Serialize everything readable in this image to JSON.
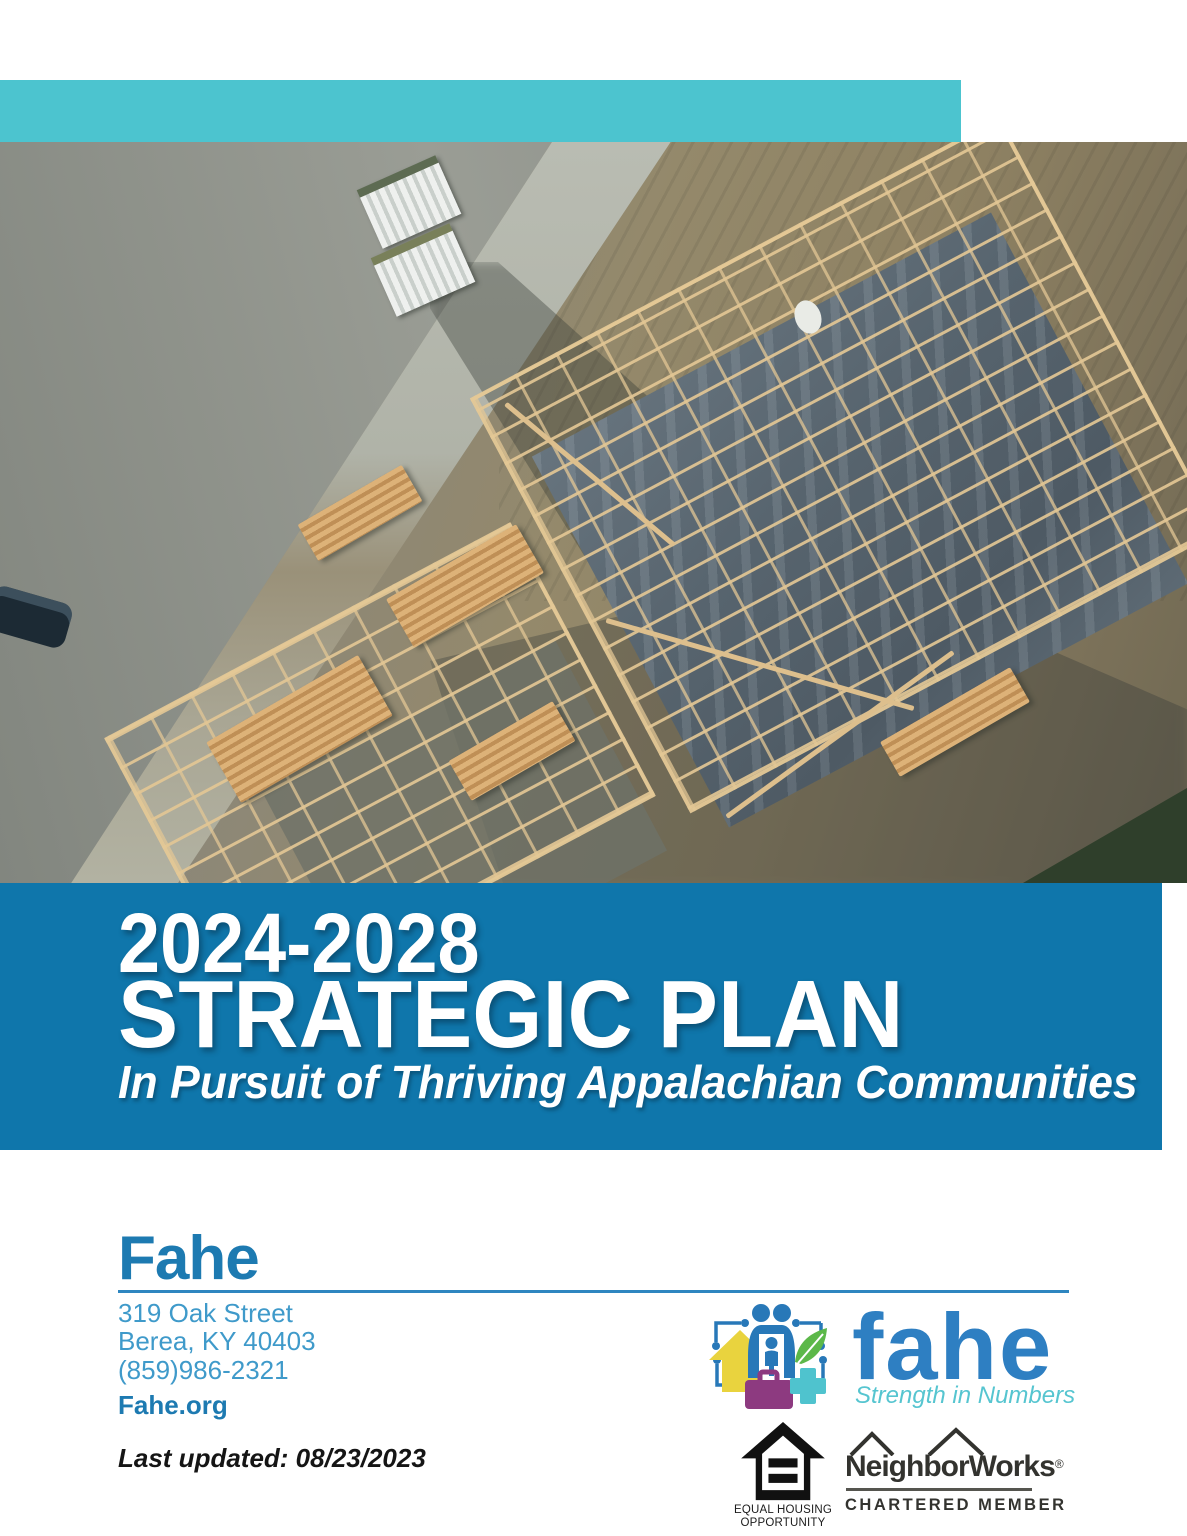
{
  "cover": {
    "band_title_years": "2024-2028",
    "band_title_main": "STRATEGIC PLAN",
    "band_subtitle": "In Pursuit of Thriving Appalachian Communities"
  },
  "contact": {
    "org_name": "Fahe",
    "address_line1": "319 Oak Street",
    "address_line2": "Berea, KY 40403",
    "phone": "(859)986-2321",
    "website": "Fahe.org",
    "last_updated": "Last updated: 08/23/2023"
  },
  "logos": {
    "fahe": {
      "wordmark": "fahe",
      "tagline": "Strength in Numbers"
    },
    "equal_housing": {
      "line1": "EQUAL HOUSING",
      "line2": "OPPORTUNITY"
    },
    "neighborworks": {
      "name": "NeighborWorks",
      "registered_mark": "®",
      "subtitle": "CHARTERED MEMBER"
    }
  },
  "colors": {
    "teal_band": "#4cc4cf",
    "blue_band": "#0f76ab",
    "heading_blue": "#1d7ab1",
    "contact_blue": "#3f9aca",
    "wordmark_blue": "#2e7fc2",
    "tagline_teal": "#56c5d0"
  }
}
